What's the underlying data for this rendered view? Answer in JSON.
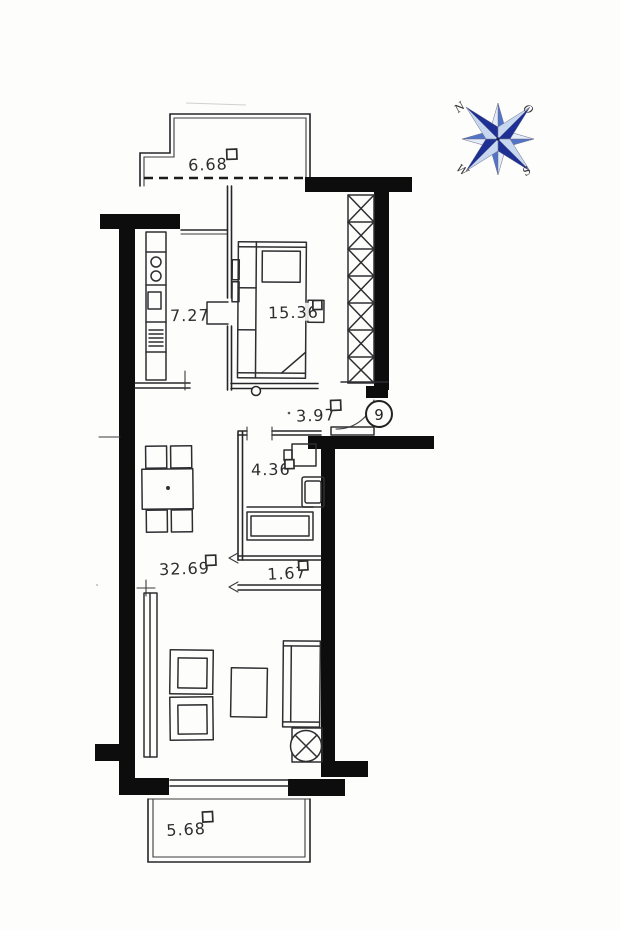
{
  "plan": {
    "apartment_number": "9",
    "areas": {
      "balcony_top": "6.68",
      "kitchen": "7.27",
      "bedroom": "15.36",
      "hallway": "3.97",
      "bathroom": "4.36",
      "storage": "1.67",
      "living_room": "32.69",
      "balcony_bottom": "5.68"
    }
  },
  "compass": {
    "north": "N",
    "east": "O",
    "south": "S",
    "west": "W",
    "colors": {
      "dark": "#1e3093",
      "light": "#c7d7f0",
      "mid": "#5274c8",
      "pale": "#e4ecf8"
    }
  },
  "colors": {
    "wall": "#0d0d0d",
    "line": "#26262a",
    "background": "#fdfdfb"
  }
}
